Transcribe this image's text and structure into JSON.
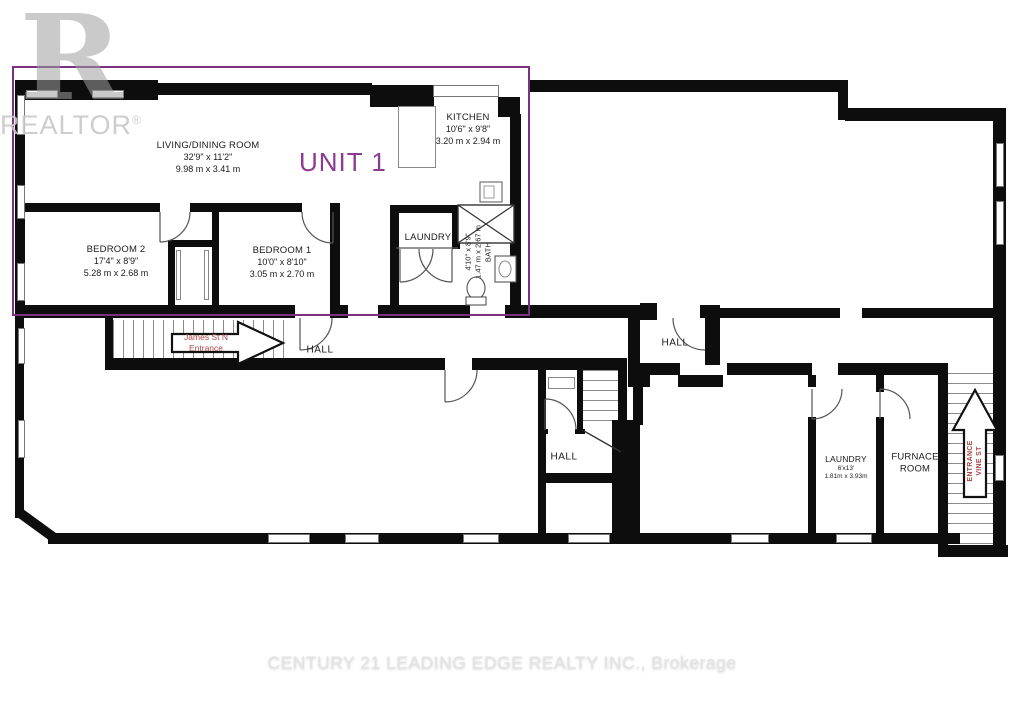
{
  "watermarks": {
    "logo_glyph": "R",
    "brand": "REALTOR",
    "registered": "®",
    "footer": "CENTURY 21 LEADING EDGE REALTY INC., Brokerage"
  },
  "unit": {
    "label": "UNIT 1"
  },
  "rooms": [
    {
      "name": "LIVING/DINING ROOM",
      "dims_ft": "32'9\" x 11'2\"",
      "dims_m": "9.98 m x 3.41 m"
    },
    {
      "name": "KITCHEN",
      "dims_ft": "10'6\" x 9'8\"",
      "dims_m": "3.20 m x 2.94 m"
    },
    {
      "name": "BEDROOM 2",
      "dims_ft": "17'4\" x 8'9\"",
      "dims_m": "5.28 m x 2.68 m"
    },
    {
      "name": "BEDROOM 1",
      "dims_ft": "10'0\" x 8'10\"",
      "dims_m": "3.05 m x 2.70 m"
    },
    {
      "name": "LAUNDRY"
    },
    {
      "name": "BATH",
      "dims_ft": "4'10\" x 8'9\"",
      "dims_m": "1.47 m x 2.67 m"
    },
    {
      "name": "HALL"
    },
    {
      "name": "HALL"
    },
    {
      "name": "HALL"
    },
    {
      "name": "LAUNDRY",
      "dims_ft": "6'x13'",
      "dims_m": "1.81m x 3.93m"
    },
    {
      "name": "FURNACE ROOM"
    }
  ],
  "entrances": [
    {
      "line1": "James St N",
      "line2": "Entrance"
    },
    {
      "line1": "VINE ST",
      "line2": "ENTRANCE"
    }
  ],
  "colors": {
    "wall": "#0d0d0d",
    "unit_outline": "#7b3183",
    "unit_label": "#8a3b92",
    "entrance_text": "#ae4747",
    "watermark_gray": "#c8c8c8"
  }
}
